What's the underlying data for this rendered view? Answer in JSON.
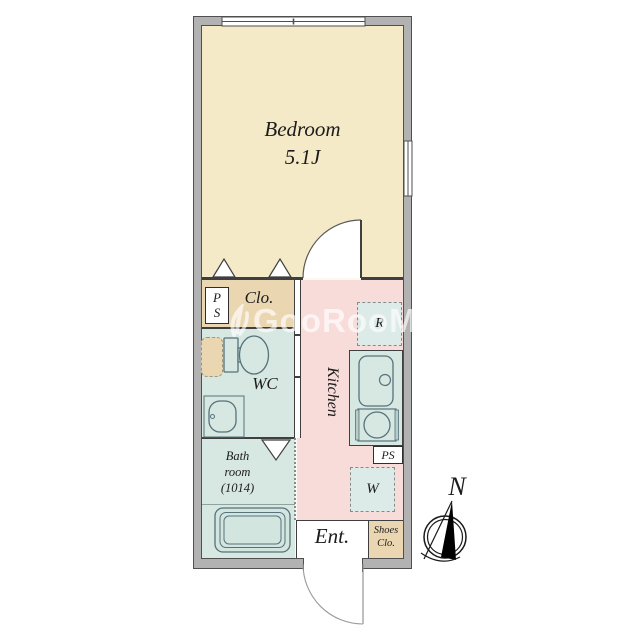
{
  "watermark": {
    "text": "GooRooM"
  },
  "rooms": {
    "bedroom": {
      "name": "Bedroom",
      "size": "5.1J"
    },
    "closet": {
      "label": "Clo."
    },
    "pipe_space_top": {
      "line1": "P",
      "line2": "S"
    },
    "wc": {
      "label": "WC"
    },
    "bathroom": {
      "line1": "Bath",
      "line2": "room",
      "line3": "(1014)"
    },
    "kitchen": {
      "label": "Kitchen"
    },
    "refrigerator_space": {
      "label": "R"
    },
    "pipe_space_bottom": {
      "label": "PS"
    },
    "washer_space": {
      "label": "W"
    },
    "entrance": {
      "label": "Ent."
    },
    "shoes_closet": {
      "line1": "Shoes",
      "line2": "Clo."
    }
  },
  "compass": {
    "north_label": "N"
  },
  "colors": {
    "wall_gray": "#b2b2b2",
    "outline": "#3f3f3f",
    "bedroom_tan": "#f5eac8",
    "closet_tan": "#ead7b2",
    "water_teal": "#d7e8e2",
    "kitchen_pink": "#f8dcda"
  }
}
